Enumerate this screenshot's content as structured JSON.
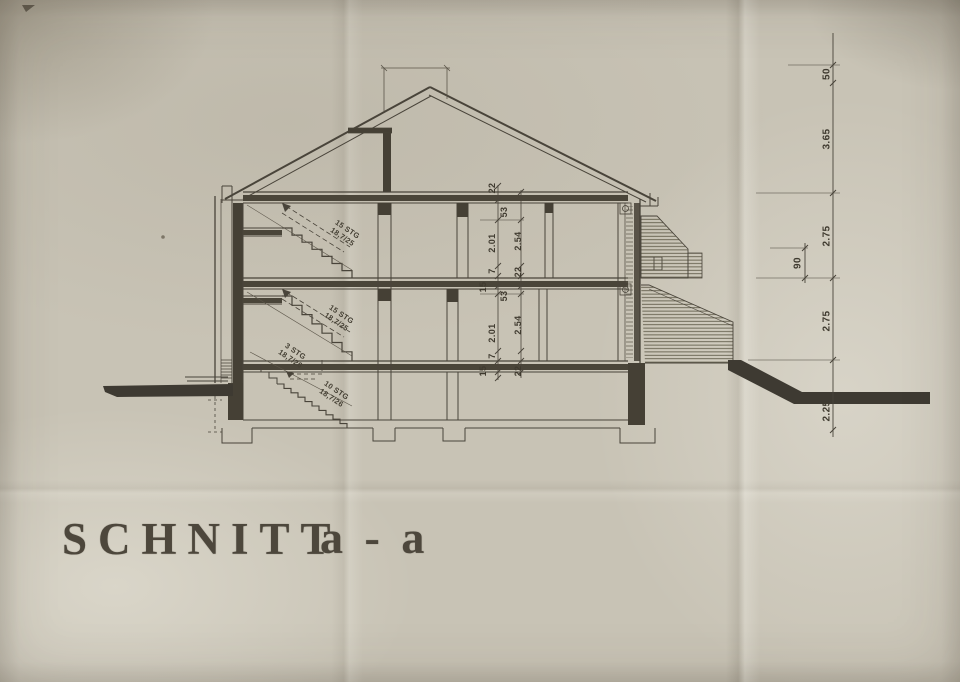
{
  "title": {
    "main": "SCHNITT",
    "section": "a - a"
  },
  "stairs": [
    {
      "line1": "15 STG",
      "line2": "18,7/25"
    },
    {
      "line1": "15 STG",
      "line2": "18,7/25"
    },
    {
      "line1": "3 STG",
      "line2": "18,7/26"
    },
    {
      "line1": "10 STG",
      "line2": "18,7/26"
    }
  ],
  "dims": {
    "interior_upper": [
      "22",
      "53",
      "2.01",
      "2.54",
      "7",
      "22",
      "15"
    ],
    "interior_lower": [
      "53",
      "2.01",
      "2.54",
      "7",
      "15",
      "22"
    ],
    "right_chain": [
      "50",
      "3.65",
      "2.75",
      "90",
      "2.75",
      "2.25"
    ]
  },
  "colors": {
    "ink": "#49443a",
    "dark_fill": "#454035",
    "terrain": "#3e3a32",
    "paper": "#c8c3b5"
  }
}
